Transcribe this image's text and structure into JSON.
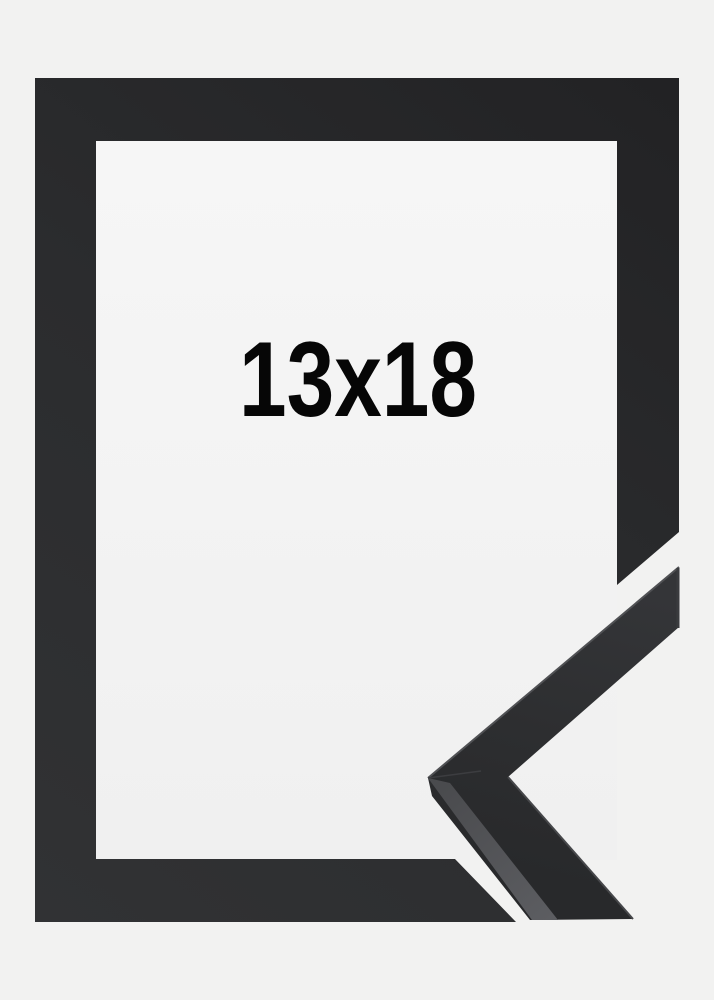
{
  "frame": {
    "size_label": "13x18",
    "description": "Black picture frame product photo with corner profile sample"
  },
  "colors": {
    "background": "#f2f2f1",
    "window_top": "#f6f6f6",
    "window_bottom": "#f0f0f0",
    "frame_dark": "#232325",
    "frame_mid": "#2b2c2e",
    "frame_light": "#313234",
    "corner_face_light": "#333438",
    "corner_face_dark": "#28292b",
    "corner_top_face": "#55565a",
    "edge_highlight": "#505154",
    "label_text": "#060606"
  }
}
